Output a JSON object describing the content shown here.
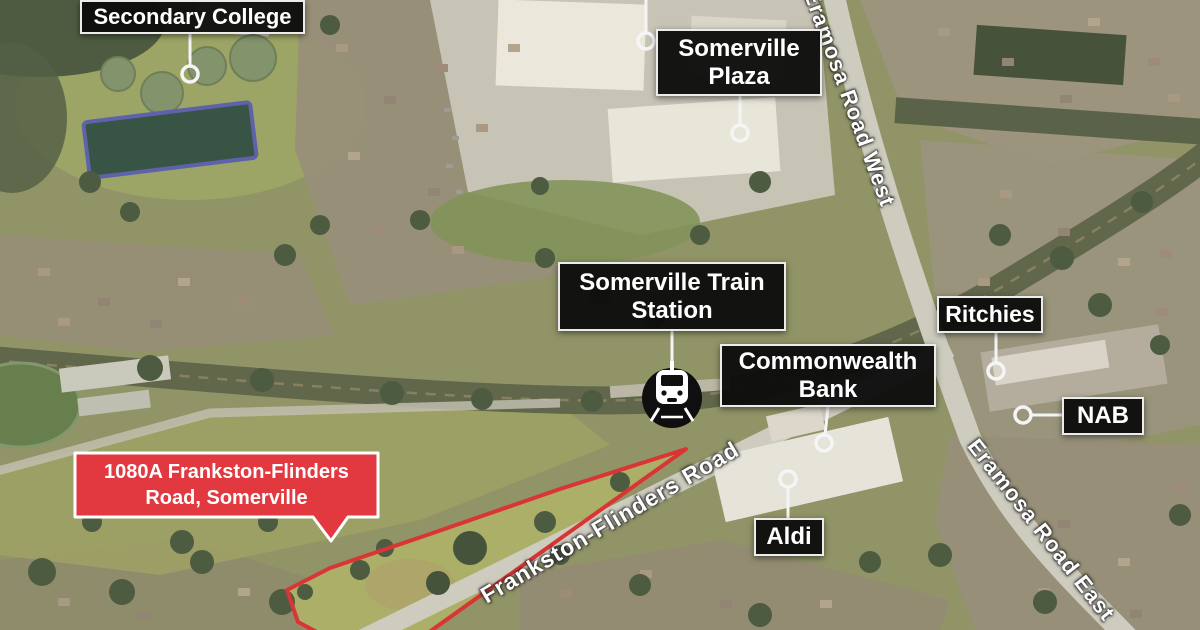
{
  "map": {
    "pois": [
      {
        "id": "secondary-college",
        "label": "Secondary College"
      },
      {
        "id": "somerville-plaza",
        "label": "Somerville Plaza"
      },
      {
        "id": "somerville-train-station",
        "label": "Somerville Train Station"
      },
      {
        "id": "commonwealth-bank",
        "label": "Commonwealth Bank"
      },
      {
        "id": "ritchies",
        "label": "Ritchies"
      },
      {
        "id": "nab",
        "label": "NAB"
      },
      {
        "id": "aldi",
        "label": "Aldi"
      }
    ],
    "roads": [
      {
        "id": "eramosa-road-west",
        "label": "Eramosa Road West"
      },
      {
        "id": "eramosa-road-east",
        "label": "Eramosa Road East"
      },
      {
        "id": "frankston-flinders-road",
        "label": "Frankston-Flinders Road"
      }
    ],
    "property": {
      "label": "1080A Frankston-Flinders Road, Somerville",
      "bubble_color": "#e23940",
      "boundary_color": "#d93535"
    },
    "markers": [
      {
        "id": "train-station-marker",
        "icon": "train-icon"
      }
    ],
    "style": {
      "poi_label_bg": "#0d0d0d",
      "poi_label_text": "#ffffff",
      "callout_color": "#f5f5f5"
    }
  }
}
